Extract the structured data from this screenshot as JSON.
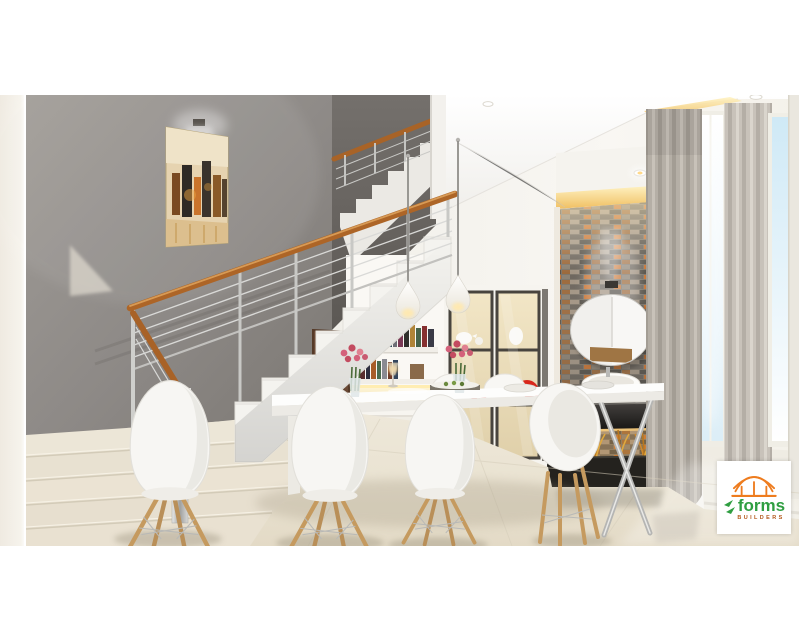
{
  "brand": {
    "logo_text": "forms",
    "logo_subtext": "BUILDERS",
    "logo_orange": "#ee7c1e",
    "logo_green": "#2f9e41",
    "logo_sub_color": "#b4591c"
  },
  "palette": {
    "wall_gray": "#8d8986",
    "upper_wall_gray": "#6e6a66",
    "handrail_wood": "#ad6527",
    "floor_cream": "#eae3d3",
    "accent_red": "#d2271f",
    "stone_orange": "#c8742e",
    "curtain_gray": "#b5afa6",
    "cove_light": "#ffe9a6",
    "chrome": "#c8c8c5"
  },
  "scene": {
    "description": "3D interior visualization of a double-height dining room with L-shaped staircase",
    "objects": [
      "staircase",
      "marble-base-steps",
      "cable-railing",
      "wood-handrail",
      "chrome-newel-post",
      "wall-art-cityscape",
      "picture-spotlight",
      "pendant-lamps",
      "dining-table",
      "eames-chairs",
      "rose-bouquets",
      "candle-glass",
      "bookshelf",
      "display-cabinet",
      "red-ceramics",
      "white-ceramics",
      "brown-door",
      "stone-accent-wall",
      "round-mirror",
      "wall-sconce",
      "vessel-sink",
      "vanity-counter",
      "dark-vanity-drawer",
      "planter-grasses",
      "curtains",
      "windows",
      "marble-floor",
      "ceiling-spotlights",
      "builder-logo"
    ]
  }
}
